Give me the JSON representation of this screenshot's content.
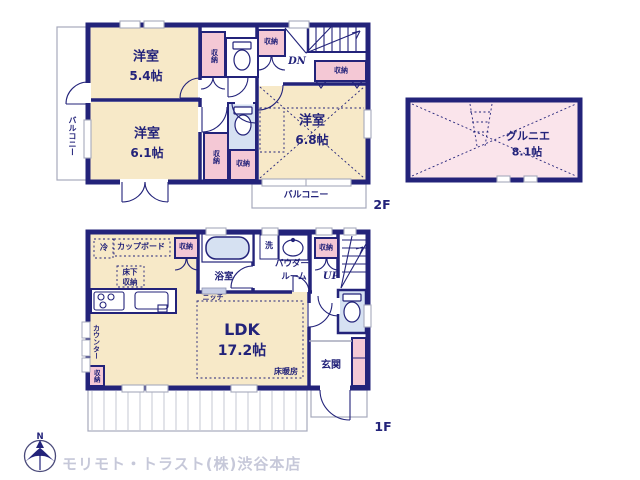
{
  "palette": {
    "wall_navy": "#23237A",
    "room_beige": "#F7E9C8",
    "closet_pink": "#F4C8D5",
    "loft_pink": "#FAE4EB",
    "water_blue": "#D6E1F2",
    "line_gray": "#A6A9BC",
    "footer_gray": "#C6C8D9"
  },
  "floor2": {
    "floor_label": "2F",
    "bedroom1": {
      "name": "洋室",
      "size": "5.4帖"
    },
    "bedroom2": {
      "name": "洋室",
      "size": "6.1帖"
    },
    "bedroom3": {
      "name": "洋室",
      "size": "6.8帖"
    },
    "balcony_left": "バルコニー",
    "balcony_bottom": "バルコニー",
    "stairs_down": "DN",
    "storage": "収納"
  },
  "loft": {
    "name": "グルニエ",
    "size": "8.1帖"
  },
  "floor1": {
    "floor_label": "1F",
    "ldk": {
      "name": "LDK",
      "size": "17.2帖"
    },
    "floor_heating": "床暖房",
    "bathroom": "浴室",
    "washer": "洗",
    "refrigerator": "冷",
    "cupboard": "カップボード",
    "powder_room_line1": "パウダー",
    "powder_room_line2": "ルーム",
    "underfloor_storage_line1": "床下",
    "underfloor_storage_line2": "収納",
    "niche": "ニッチ",
    "counter": "カウンター",
    "entrance": "玄関",
    "stairs_up": "UP",
    "storage": "収納"
  },
  "footer": {
    "company": "モリモト・トラスト(株)渋谷本店",
    "compass_north": "N"
  }
}
